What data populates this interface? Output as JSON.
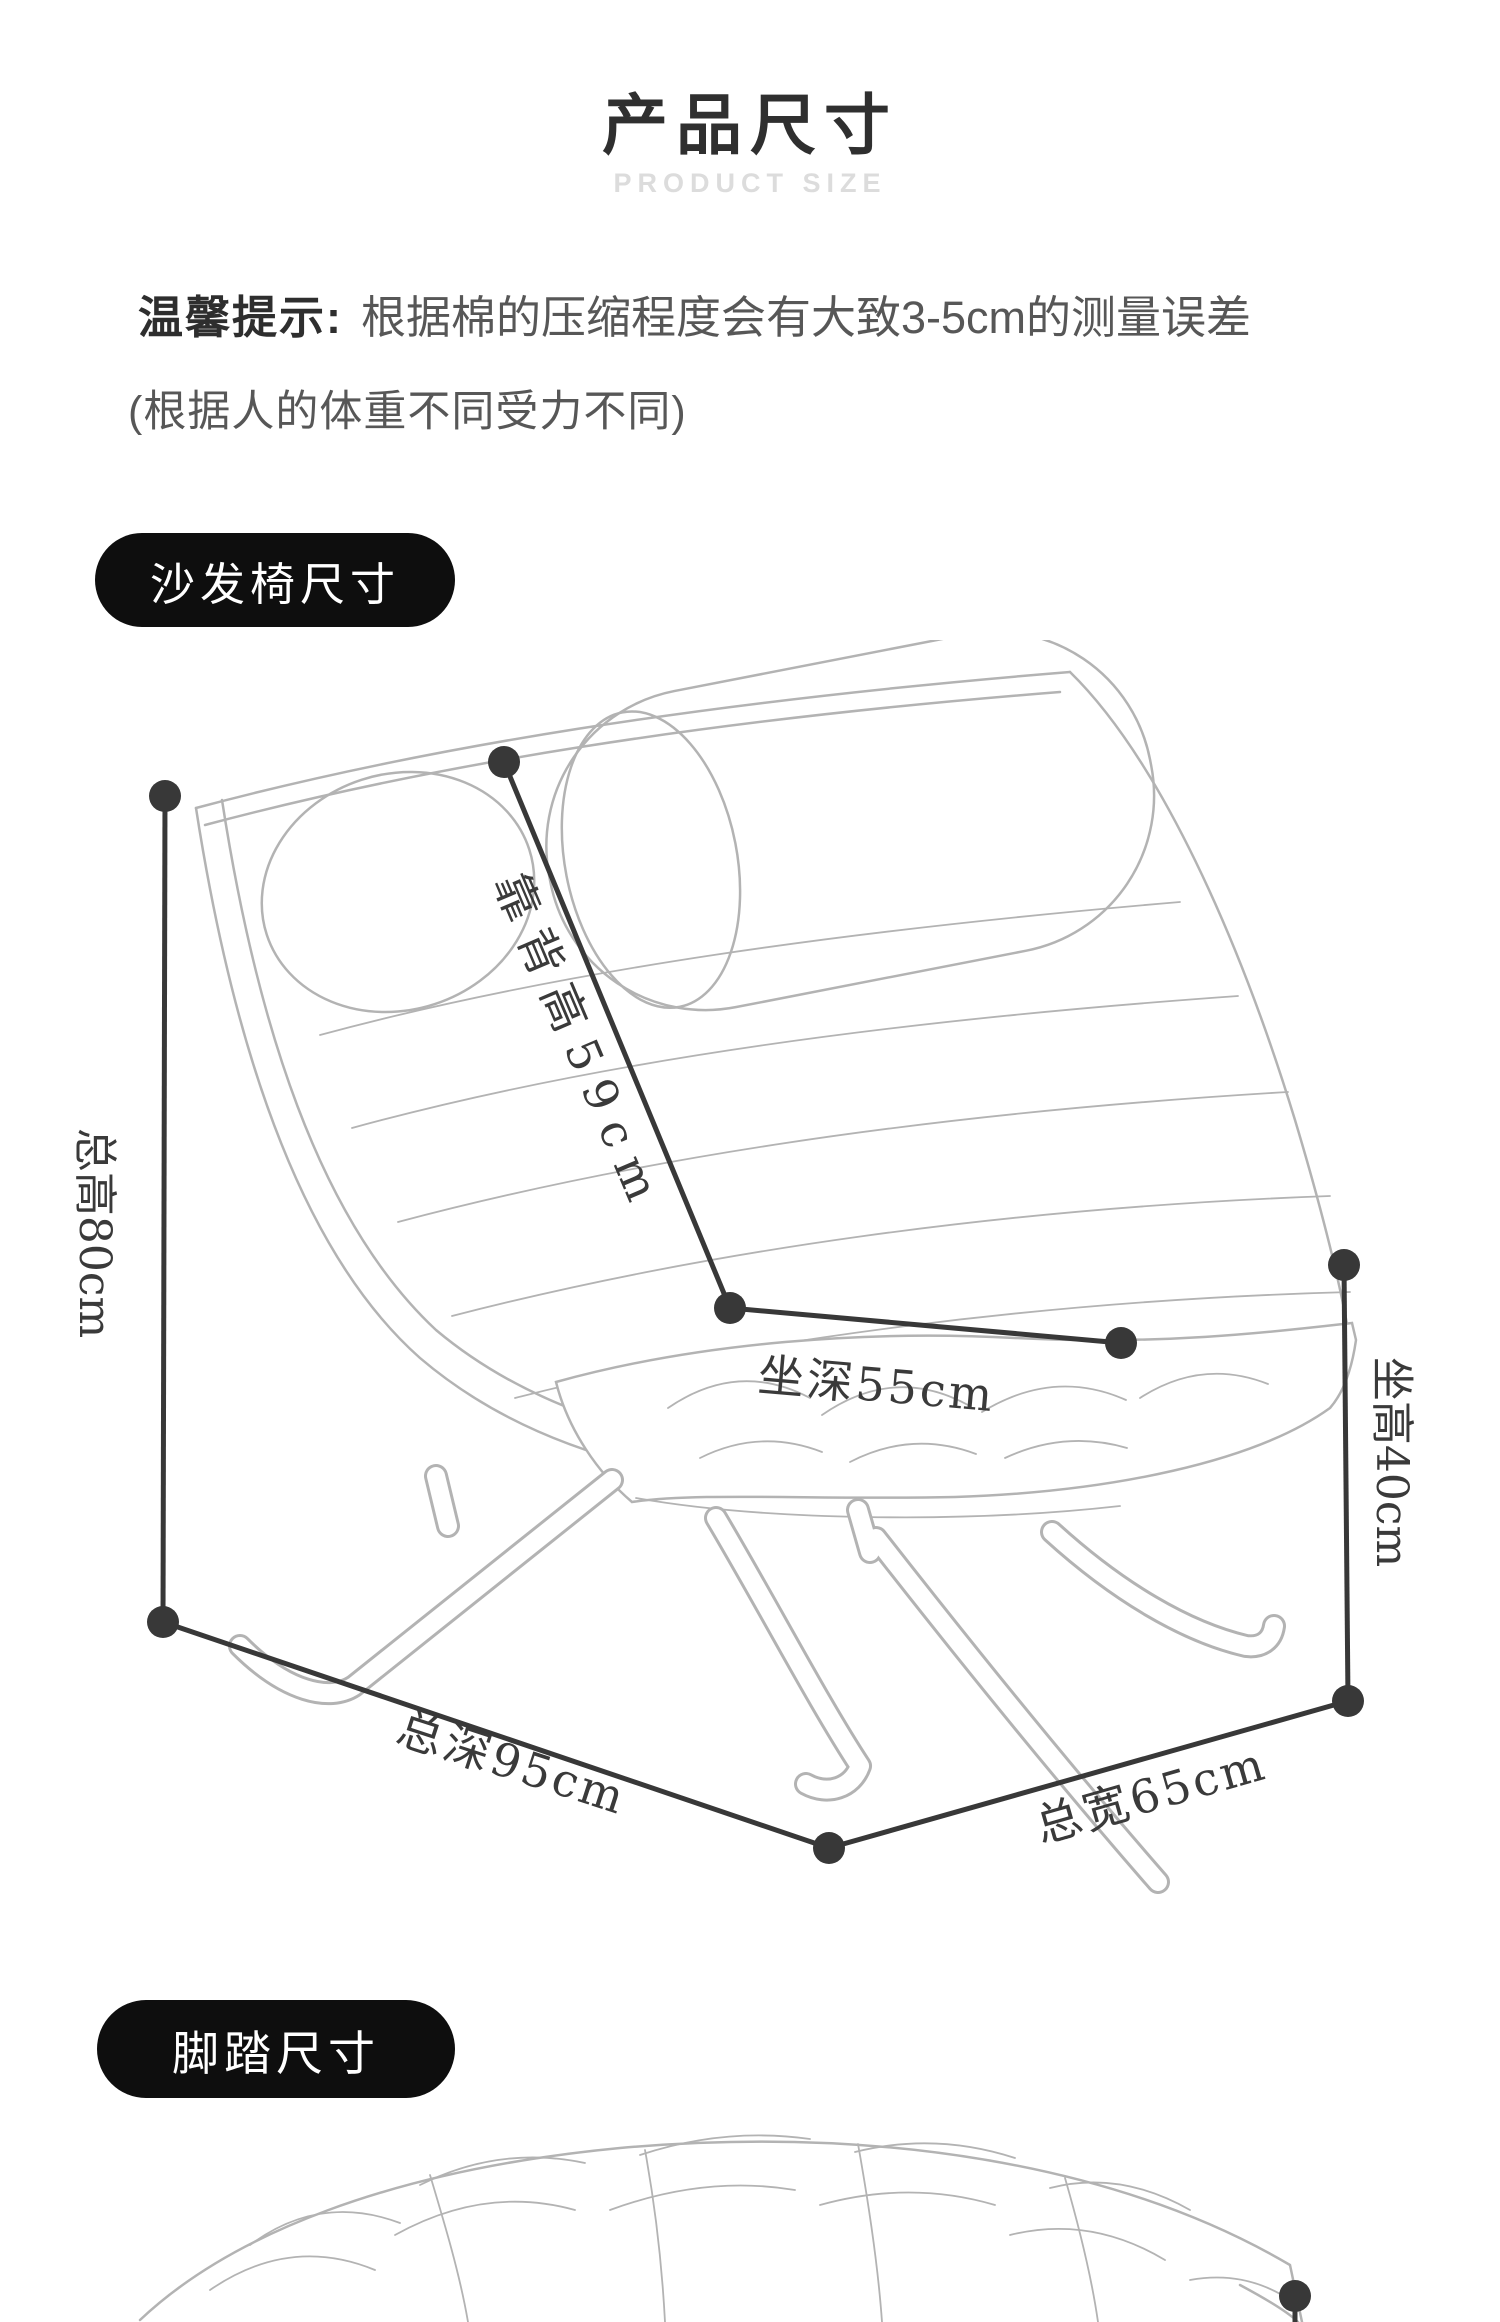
{
  "page": {
    "title": "产品尺寸",
    "subtitle": "PRODUCT SIZE"
  },
  "notice": {
    "label": "温馨提示:",
    "line1": "根据棉的压缩程度会有大致3-5cm的测量误差",
    "line2": "(根据人的体重不同受力不同)"
  },
  "sections": {
    "chair": {
      "label": "沙发椅尺寸"
    },
    "footstool": {
      "label": "脚踏尺寸"
    }
  },
  "chair_dimensions": {
    "total_height": "总高80cm",
    "back_height": "靠背高59cm",
    "seat_depth": "坐深55cm",
    "seat_height": "坐高40cm",
    "total_depth": "总深95cm",
    "total_width": "总宽65cm"
  },
  "colors": {
    "dimension_line": "#383838",
    "artwork_stroke": "#b3b3b3",
    "pill_background": "#0e0e0e",
    "title_text": "#2f2f2f",
    "subtitle_text": "#dcdcdc",
    "notice_text": "#575757"
  }
}
